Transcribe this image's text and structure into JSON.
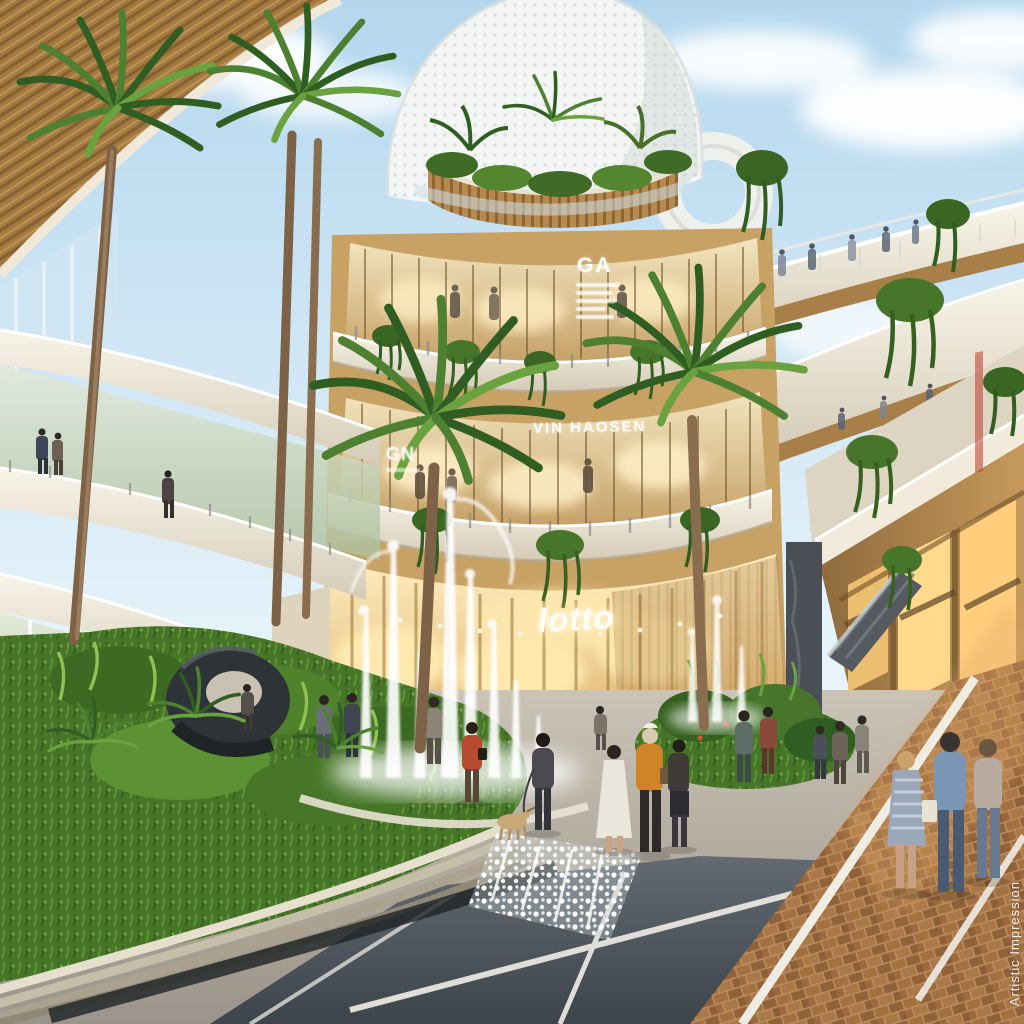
{
  "meta": {
    "kind": "architectural rendering photograph",
    "description": "Artist's impression of an open-air luxury shopping mall courtyard: curved cream balconies with glass railings, warm timber and glass storefronts, tall palm trees, hanging plants, a central fountain with tall water jets, sky bridges with pedestrians, a brick-paved promenade with shoppers, and a white perforated tower under a blue sky with clouds.",
    "watermark": "Artistic Impression"
  },
  "signs": {
    "ga": "GA",
    "gn": "GN",
    "vin_haosen": "VIN HAOSEN",
    "lotto": "lotto"
  },
  "palette": {
    "sky": "#b8d9ee",
    "cloud": "#ffffff",
    "slab_cream": "#f3eee2",
    "timber_gold": "#b6894e",
    "glass_warm": "#e8d3a4",
    "interior_glow": "#ffe9b4",
    "foliage_dark": "#2f5d22",
    "foliage_mid": "#4d8030",
    "foliage_light": "#6aa23f",
    "brick": "#a2713f",
    "plaza_concrete": "#b5ada0",
    "dark_paving": "#4d545b",
    "water": "#ffffff"
  },
  "scene": {
    "elements": [
      "sky with clouds",
      "white perforated tower",
      "roof garden",
      "sky bridge with people",
      "curved balcony slabs",
      "glass storefronts",
      "store sign GA",
      "store sign GN",
      "store sign VIN HAOSEN",
      "glowing lotto sign",
      "palm trees",
      "hanging vines",
      "fountain jets",
      "abstract dark sculpture",
      "curved planter with ledges",
      "water cascade",
      "dark slab paving with white lines",
      "herringbone brick promenade",
      "escalator",
      "shoppers and pedestrians",
      "dog",
      "watermark Artistic Impression"
    ]
  }
}
